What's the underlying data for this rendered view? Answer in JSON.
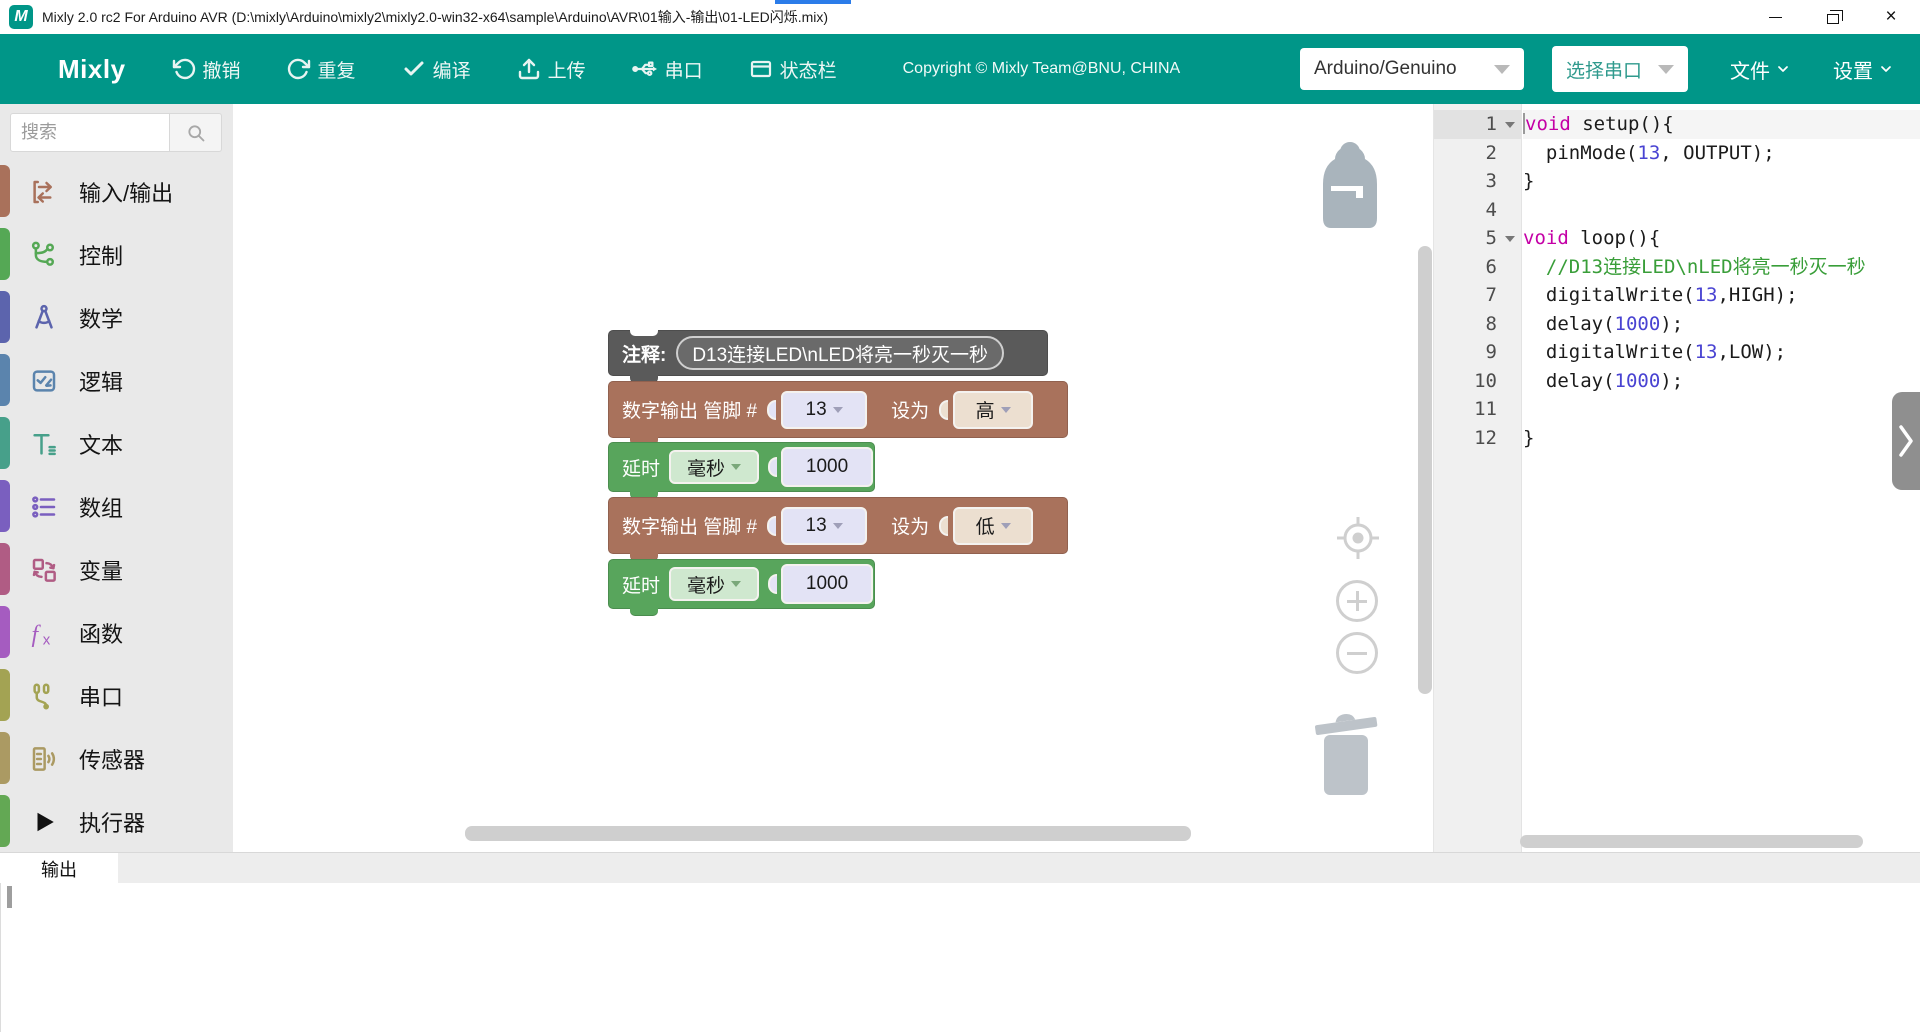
{
  "window": {
    "title": "Mixly 2.0 rc2 For Arduino AVR (D:\\mixly\\Arduino\\mixly2\\mixly2.0-win32-x64\\sample\\Arduino\\AVR\\01输入-输出\\01-LED闪烁.mix)",
    "logo_letter": "M",
    "accent_color": "#2b7ce9",
    "controls": {
      "minimize_glyph": "",
      "close_glyph": "×"
    }
  },
  "toolbar": {
    "color": "#009688",
    "brand": "Mixly",
    "buttons": [
      {
        "icon": "undo-icon",
        "label": "撤销"
      },
      {
        "icon": "redo-icon",
        "label": "重复"
      },
      {
        "icon": "compile-icon",
        "label": "编译"
      },
      {
        "icon": "upload-icon",
        "label": "上传"
      },
      {
        "icon": "serial-icon",
        "label": "串口"
      },
      {
        "icon": "statusbar-icon",
        "label": "状态栏"
      }
    ],
    "copyright": "Copyright © Mixly Team@BNU, CHINA",
    "board_select": {
      "value": "Arduino/Genuino"
    },
    "port_select": {
      "value": "选择串口"
    },
    "menus": [
      {
        "label": "文件"
      },
      {
        "label": "设置"
      }
    ]
  },
  "sidebar": {
    "search": {
      "placeholder": "搜索"
    },
    "items": [
      {
        "label": "输入/输出",
        "icon": "io-icon",
        "color": "#a9715b"
      },
      {
        "label": "控制",
        "icon": "control-icon",
        "color": "#55a855"
      },
      {
        "label": "数学",
        "icon": "math-icon",
        "color": "#5c64ad"
      },
      {
        "label": "逻辑",
        "icon": "logic-icon",
        "color": "#5b84ad"
      },
      {
        "label": "文本",
        "icon": "text-icon",
        "color": "#47a08a"
      },
      {
        "label": "数组",
        "icon": "array-icon",
        "color": "#7a5fbf"
      },
      {
        "label": "变量",
        "icon": "variable-icon",
        "color": "#b05c84"
      },
      {
        "label": "函数",
        "icon": "function-icon",
        "color": "#a55cc0"
      },
      {
        "label": "串口",
        "icon": "serial-plug-icon",
        "color": "#a3a353"
      },
      {
        "label": "传感器",
        "icon": "sensor-icon",
        "color": "#ab9a63"
      },
      {
        "label": "执行器",
        "icon": "actuator-icon",
        "color": "#63a854"
      }
    ]
  },
  "palette": {
    "pin_field": "#e3e3f5",
    "state_field": "#ecdfd0",
    "unit_field": "#cfe8cf",
    "num_field": "#e3e3f5"
  },
  "blocks": {
    "comment": {
      "color": "#5a5a5a",
      "label": "注释:",
      "text": "D13连接LED\\nLED将亮一秒灭一秒"
    },
    "digital_write_1": {
      "color": "#a9725c",
      "label": "数字输出 管脚 #",
      "pin": "13",
      "set_label": "设为",
      "value": "高"
    },
    "delay_1": {
      "color": "#58a55c",
      "label": "延时",
      "unit": "毫秒",
      "value": "1000"
    },
    "digital_write_2": {
      "color": "#a9725c",
      "label": "数字输出 管脚 #",
      "pin": "13",
      "set_label": "设为",
      "value": "低"
    },
    "delay_2": {
      "color": "#58a55c",
      "label": "延时",
      "unit": "毫秒",
      "value": "1000"
    }
  },
  "icons": {
    "search": "magnifier",
    "undo": "counterclockwise-arrow",
    "redo": "clockwise-arrow",
    "compile": "checkmark",
    "upload": "tray-up-arrow",
    "serial": "usb-branch",
    "statusbar": "window-frame",
    "chevron-down": "v",
    "backpack": "backpack",
    "zoom-reset": "crosshair-target",
    "zoom-in": "circled-plus",
    "zoom-out": "circled-minus",
    "trash": "trash-can",
    "collapse": "chevron-right",
    "fold": "triangle-down"
  },
  "code": {
    "lines": [
      {
        "n": "1",
        "fold": true,
        "active": true,
        "tokens": [
          [
            "kw",
            "void"
          ],
          [
            "pl",
            " setup(){"
          ]
        ]
      },
      {
        "n": "2",
        "tokens": [
          [
            "pl",
            "  pinMode("
          ],
          [
            "num",
            "13"
          ],
          [
            "pl",
            ", OUTPUT);"
          ]
        ]
      },
      {
        "n": "3",
        "tokens": [
          [
            "pl",
            "}"
          ]
        ]
      },
      {
        "n": "4",
        "tokens": []
      },
      {
        "n": "5",
        "fold": true,
        "tokens": [
          [
            "kw",
            "void"
          ],
          [
            "pl",
            " loop(){"
          ]
        ]
      },
      {
        "n": "6",
        "tokens": [
          [
            "cm",
            "  //D13连接LED\\nLED将亮一秒灭一秒"
          ]
        ]
      },
      {
        "n": "7",
        "tokens": [
          [
            "pl",
            "  digitalWrite("
          ],
          [
            "num",
            "13"
          ],
          [
            "pl",
            ",HIGH);"
          ]
        ]
      },
      {
        "n": "8",
        "tokens": [
          [
            "pl",
            "  delay("
          ],
          [
            "num",
            "1000"
          ],
          [
            "pl",
            ");"
          ]
        ]
      },
      {
        "n": "9",
        "tokens": [
          [
            "pl",
            "  digitalWrite("
          ],
          [
            "num",
            "13"
          ],
          [
            "pl",
            ",LOW);"
          ]
        ]
      },
      {
        "n": "10",
        "tokens": [
          [
            "pl",
            "  delay("
          ],
          [
            "num",
            "1000"
          ],
          [
            "pl",
            ");"
          ]
        ]
      },
      {
        "n": "11",
        "tokens": []
      },
      {
        "n": "12",
        "tokens": [
          [
            "pl",
            "}"
          ]
        ]
      }
    ]
  },
  "output_panel": {
    "tab": "输出"
  }
}
